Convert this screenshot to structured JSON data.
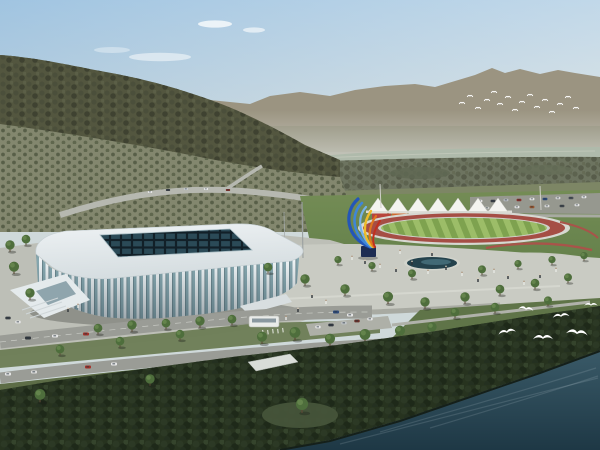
{
  "scene": {
    "subject": "aerial-rendering-stadium-riverfront",
    "field": {
      "tent_count": 7,
      "panel_colors": [
        "#b8443c",
        "#cf6a2e",
        "#2f9a8f",
        "#52a14e",
        "#3a6db2",
        "#7b4fa3",
        "#7f9a3d"
      ]
    },
    "birds": {
      "gull_count": 6,
      "distant_flock_count": 16
    }
  },
  "colors": {
    "sky_top": "#a9c9e1",
    "sky_horizon": "#e0e4de",
    "mountain_far": "#9b9481",
    "mountain_near": "#53563f",
    "orchard": "#83876e",
    "river": "#afbaab",
    "bank_trees": "#6d7460",
    "lawn": "#63804a",
    "parking": "#96988f",
    "tent": "#f4f4f0",
    "track": "#a54e45",
    "infield_light": "#9cbd68",
    "infield_dark": "#7ea24f",
    "plaza": "#c9cbc3",
    "pool": "#24424c",
    "stadium_roof": "#eef2f4",
    "stadium_roof_shade": "#d5dde0",
    "stadium_rib": "#edf2f4",
    "stadium_glass": "#85a6ae",
    "skylight": "#122028",
    "road": "#9a9c96",
    "grass": "#6b7c54",
    "trees_dark": "#27331f",
    "water_far": "#3a5a68",
    "water_near": "#1e3845",
    "bird": "#ffffff",
    "sculpture_blue": "#2456b8",
    "sculpture_yellow": "#eebc2a",
    "sculpture_orange": "#e0761e",
    "sculpture_red": "#c22f1e",
    "sculpture_base": "#1d2c52"
  }
}
